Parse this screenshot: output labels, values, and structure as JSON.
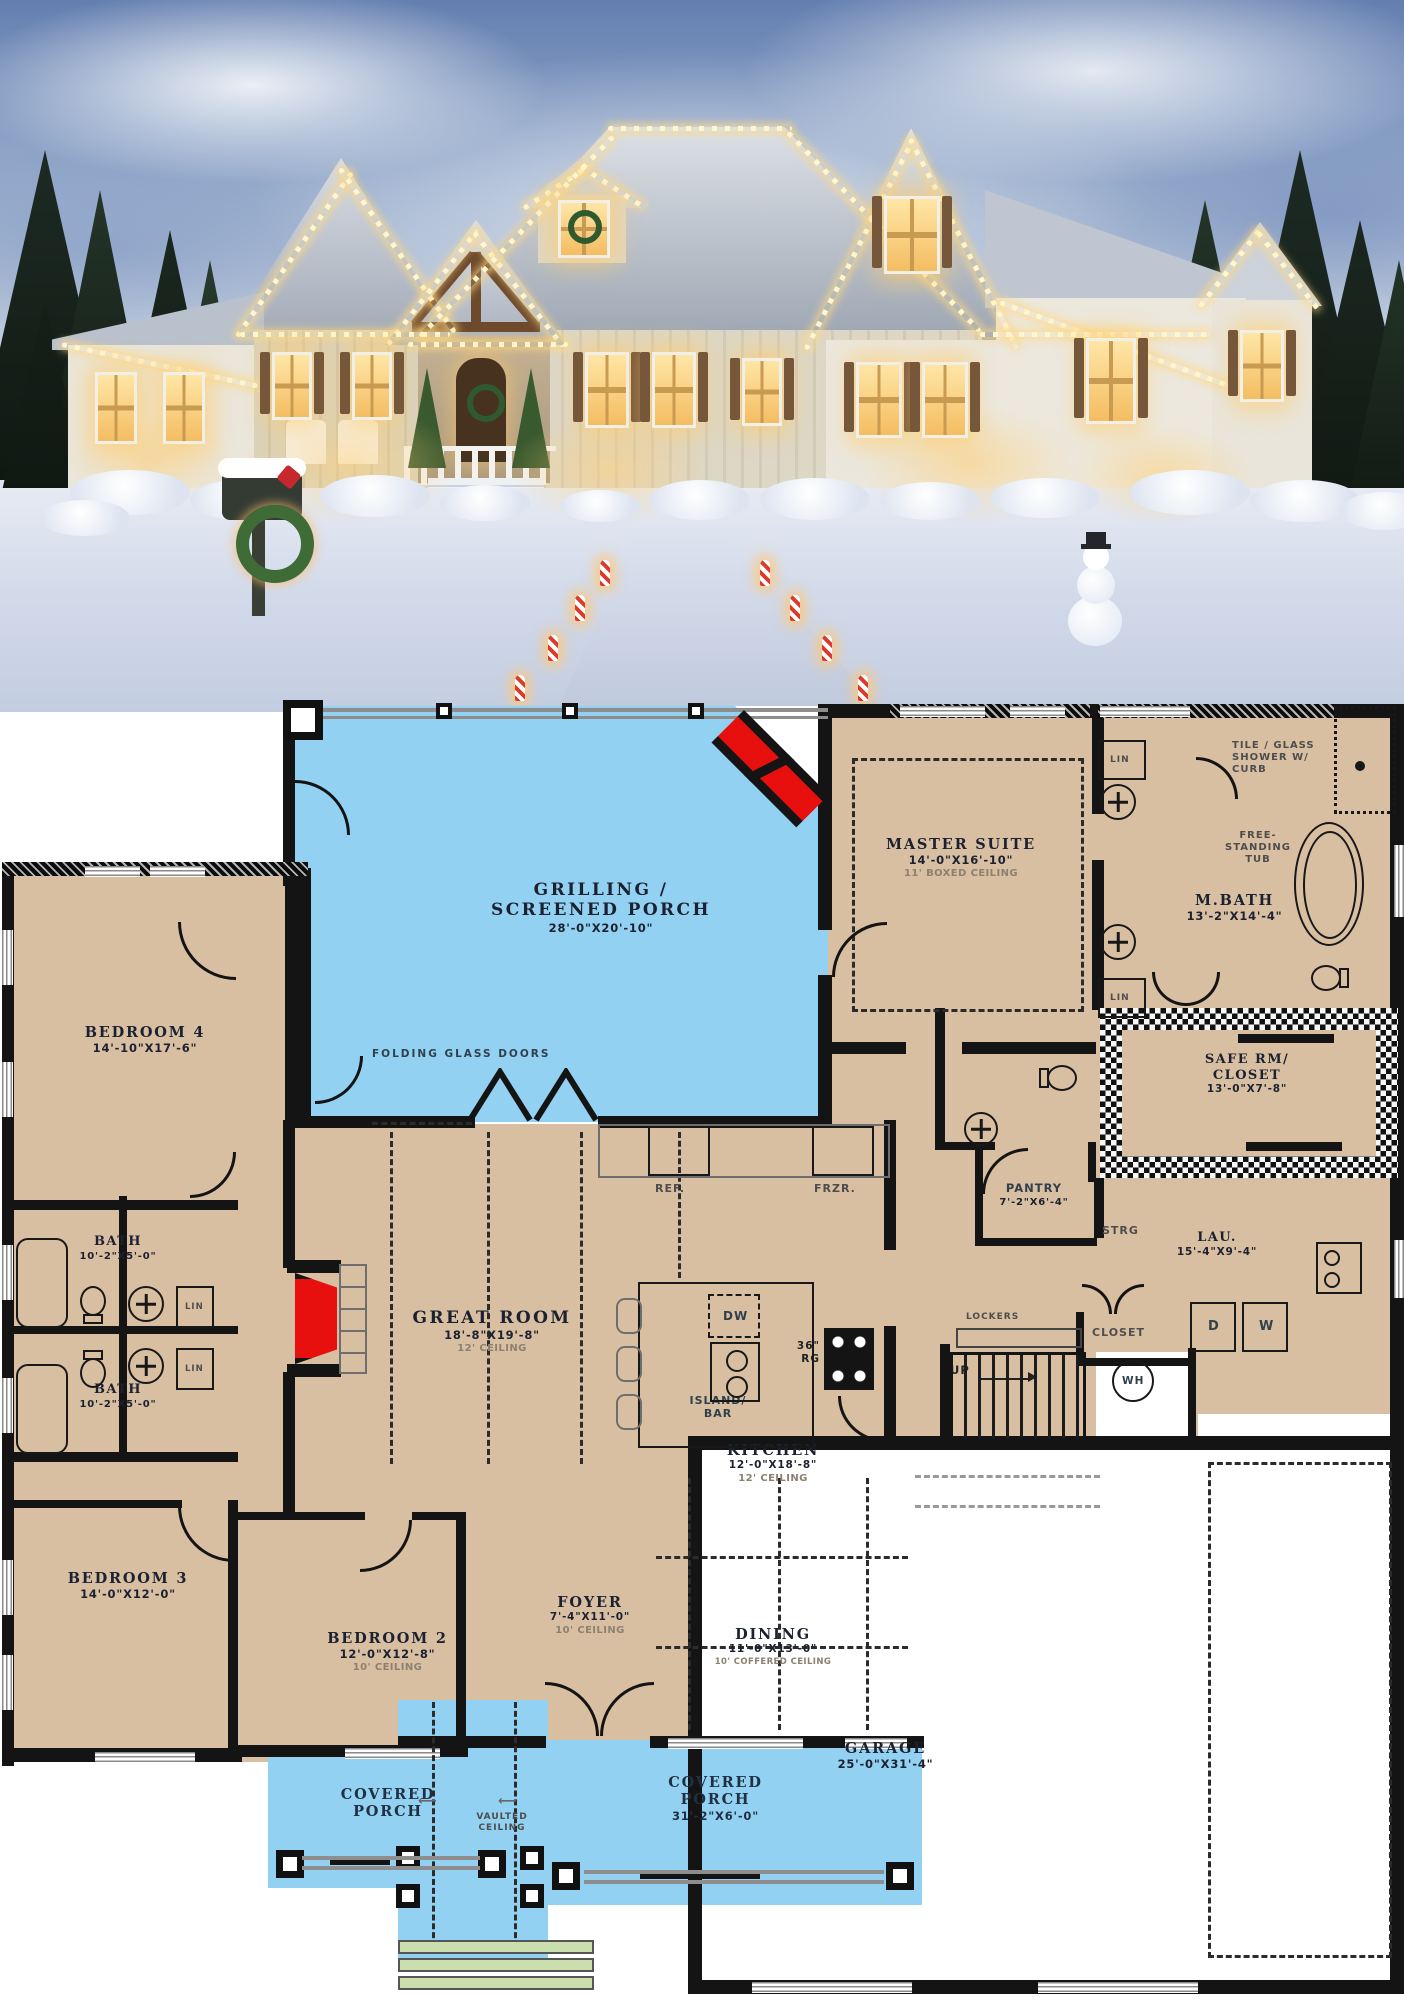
{
  "colors": {
    "plan_room_fill": "#d9bfa2",
    "plan_porch_fill": "#92d1f1",
    "plan_steps_fill": "#cbdfae",
    "plan_wall": "#141414",
    "fireplace_red": "#e8100e",
    "label_dark": "#1b2130",
    "label_gray": "#8c8070"
  },
  "rooms": {
    "porch": {
      "line1": "GRILLING /",
      "line2": "SCREENED PORCH",
      "dims": "28'-0\"X20'-10\""
    },
    "master": {
      "name": "MASTER SUITE",
      "dims": "14'-0\"X16'-10\"",
      "note": "11' BOXED CEILING"
    },
    "mbath": {
      "name": "M.BATH",
      "dims": "13'-2\"X14'-4\""
    },
    "safe": {
      "line1": "SAFE RM/",
      "line2": "CLOSET",
      "dims": "13'-0\"X7'-8\""
    },
    "bed4": {
      "name": "BEDROOM 4",
      "dims": "14'-10\"X17'-6\""
    },
    "bath_upper": {
      "name": "BATH",
      "dims": "10'-2\"X5'-0\""
    },
    "bath_lower": {
      "name": "BATH",
      "dims": "10'-2\"X5'-0\""
    },
    "great": {
      "name": "GREAT ROOM",
      "dims": "18'-8\"X19'-8\"",
      "note": "12' CEILING"
    },
    "kitchen": {
      "name": "KITCHEN",
      "dims": "12'-0\"X18'-8\"",
      "note": "12' CEILING"
    },
    "pantry": {
      "name": "PANTRY",
      "dims": "7'-2\"X6'-4\""
    },
    "laundry": {
      "name": "LAU.",
      "dims": "15'-4\"X9'-4\""
    },
    "bed3": {
      "name": "BEDROOM 3",
      "dims": "14'-0\"X12'-0\""
    },
    "bed2": {
      "name": "BEDROOM 2",
      "dims": "12'-0\"X12'-8\"",
      "note": "10' CEILING"
    },
    "foyer": {
      "name": "FOYER",
      "dims": "7'-4\"X11'-0\"",
      "note": "10' CEILING"
    },
    "dining": {
      "name": "DINING",
      "dims": "11'-0\"X13'-0\"",
      "note": "10' COFFERED CEILING"
    },
    "garage": {
      "name": "GARAGE",
      "dims": "25'-0\"X31'-4\""
    },
    "porch_left": {
      "line1": "COVERED",
      "line2": "PORCH"
    },
    "porch_right": {
      "line1": "COVERED",
      "line2": "PORCH",
      "dims": "31'-2\"X6'-0\""
    }
  },
  "labels": {
    "folding_doors": "FOLDING GLASS DOORS",
    "shower1": "TILE / GLASS",
    "shower2": "SHOWER W/",
    "shower3": "CURB",
    "tub1": "FREE-",
    "tub2": "STANDING",
    "tub3": "TUB",
    "lin": "LIN",
    "strg": "STRG",
    "lockers": "LOCKERS",
    "closet": "CLOSET",
    "up": "UP",
    "wh": "WH",
    "ref": "REF.",
    "frzr": "FRZR.",
    "dw": "DW",
    "rg1": "36\"",
    "rg2": "RG",
    "island1": "ISLAND/",
    "island2": "BAR",
    "washer": "W",
    "dryer": "D",
    "vaulted1": "VAULTED",
    "vaulted2": "CEILING"
  }
}
